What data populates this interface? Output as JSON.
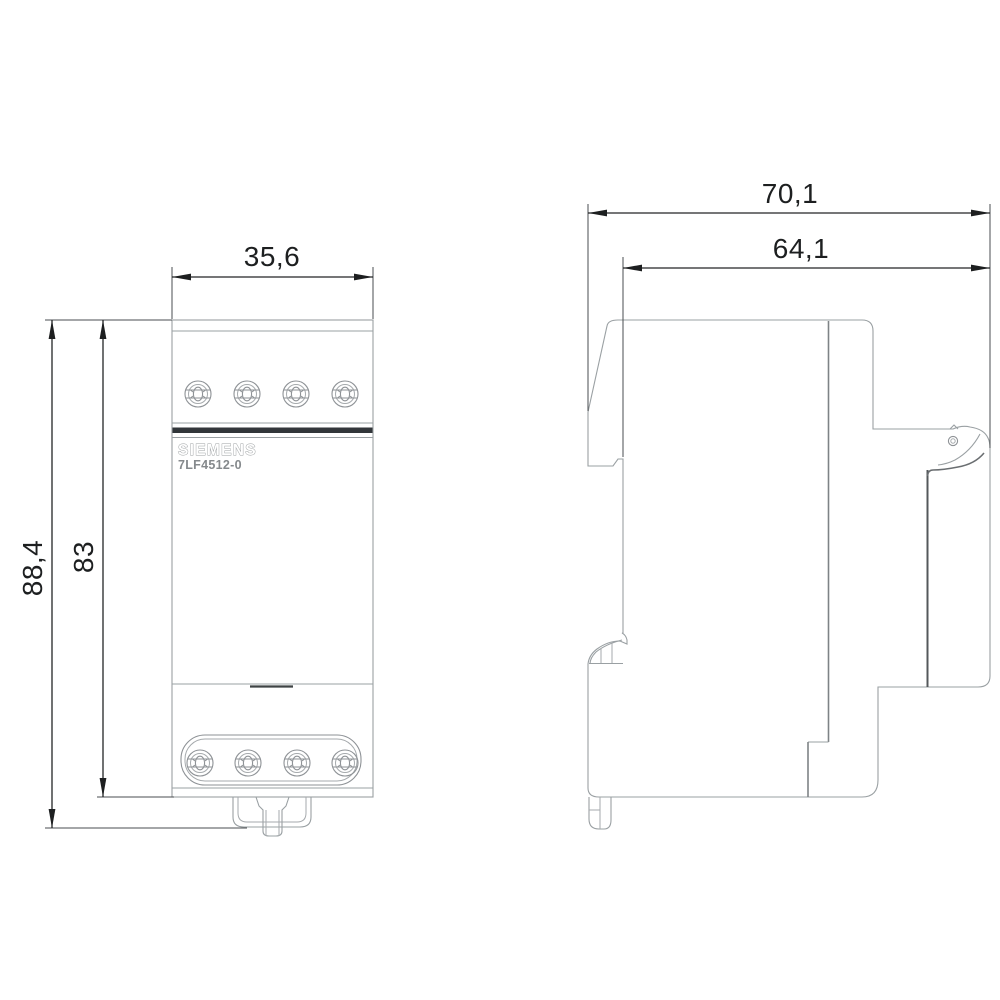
{
  "drawing": {
    "brand_label": "SIEMENS",
    "model_label": "7LF4512-0",
    "dims": {
      "front_width": "35,6",
      "total_height": "88,4",
      "body_height": "83",
      "total_depth": "70,1",
      "body_depth": "64,1"
    },
    "colors": {
      "background": "#ffffff",
      "outline_gray": "#9aa0a3",
      "dark_gray": "#54585b",
      "dimension_black": "#1d1f20",
      "label_gray": "#8a8e90",
      "seam_band": "#32363a"
    }
  }
}
